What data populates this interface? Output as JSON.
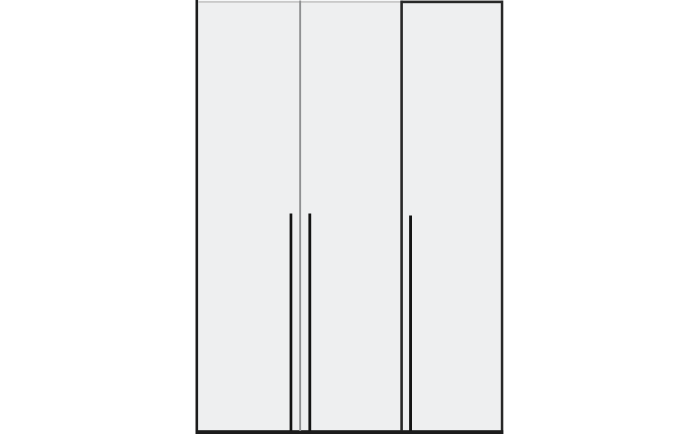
{
  "figure": {
    "description": "Front-view line drawing of a three-door wardrobe with long vertical bar handles",
    "door_count": 3,
    "handle_count": 3
  },
  "colors": {
    "background": "#ffffff",
    "door_fill": "#eeeff0",
    "outline_dark": "#1c1c1c",
    "outline_right_door": "#282828",
    "divider_light": "#8f9092",
    "top_edge_light": "#c9c9c9",
    "handle": "#141414"
  }
}
